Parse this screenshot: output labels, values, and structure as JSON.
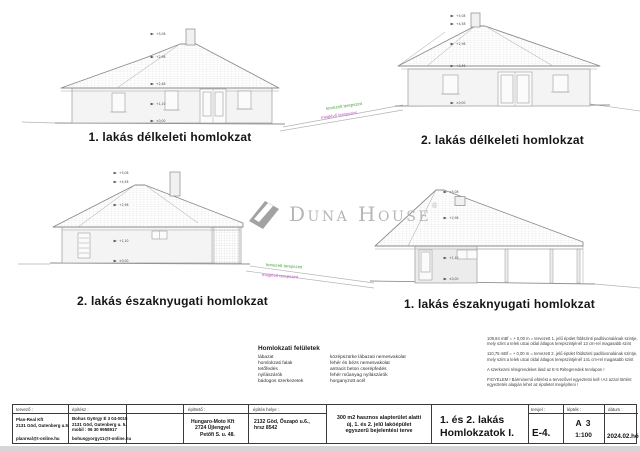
{
  "watermark": {
    "text": "Duna House",
    "reg": "®",
    "color": "#b6b6b6"
  },
  "elevation_labels": {
    "e1": "1. lakás délkeleti homlokzat",
    "e2": "2. lakás délkeleti homlokzat",
    "e3": "2. lakás északnyugati homlokzat",
    "e4": "1. lakás északnyugati homlokzat"
  },
  "terrain": {
    "planned": "tervezett terepszint",
    "existing": "meglévő terepszint",
    "planned_color": "#44a23a",
    "existing_color": "#bf4fbf"
  },
  "elevation_marks": [
    "+5,08",
    "+4,58",
    "+2,98",
    "+2,48",
    "+1,10",
    "±0,00"
  ],
  "legend": {
    "title": "Homlokzati felületek",
    "rows": [
      {
        "label": "lábazat",
        "value": "középszürke lábazati nemesvakolat"
      },
      {
        "label": "homlokzati falak",
        "value": "fehér és bézs nemesvakolat"
      },
      {
        "label": "tetőfedés",
        "value": "antracit beton cserépfedés"
      },
      {
        "label": "nyílászárók",
        "value": "fehér műanyag nyílászárók"
      },
      {
        "label": "bádogos szerkezetek",
        "value": "horganyzott acél"
      }
    ]
  },
  "notes": [
    "109,84 mBf = + 0,00 m = tervezett 1. jelű épület földszinti padlóvonalának szintje, mely szint a telek utcai oldal átlagos terepszintjénél 13 cm-rel magasabb szint",
    "110,75 mBf = + 0,00 m = tervezett 2. jelű épület földszinti padlóvonalának szintje, mely szint a telek utcai oldal átlagos terepszintjénél 141 cm-rel magasabb szint",
    "A szerkezeti rétegrendeket lásd az E-5 Rétegrendek tervlapon !",
    "FIGYELEM ! Bárminemű eltérést a tervezővel egyeztetni kell ! Az azzal történt egyeztetés alapján lehet az épületet megépíteni !"
  ],
  "titleblock": {
    "tervezo": {
      "header": "tervező :",
      "line1": "Plan-Real Kft",
      "line2": "2131 Göd, Gutenberg u.5.",
      "email": "planreal@t-online.hu"
    },
    "epitesz": {
      "header": "építész :",
      "line1": "Bohus György É 3 04-0018",
      "line2": "2131 Göd, Gutenberg u. 5.",
      "line3": "mobil : 06 30 9958917",
      "email": "bohusgyorgy11@t-online.hu"
    },
    "epitteto": {
      "header": "építtető :",
      "line1": "Hungaro-Moto Kft",
      "line2": "2724 Újlengyel",
      "line3": "Petőfi S. u. 48."
    },
    "helyszin": {
      "header": "építés helye :",
      "line1": "2132 Göd, Őszapó u.6.,",
      "line2": "hrsz 8542"
    },
    "megnevezes": {
      "line1": "300 m2 hasznos alapterület alatti",
      "line2": "új, 1. és 2. jelű lakóépület",
      "line3": "egyszerű bejelentési terve"
    },
    "rajz_cim": {
      "line1": "1. és 2. lakás",
      "line2": "Homlokzatok I."
    },
    "tervjel": {
      "header": "tervjel :",
      "value": "E-4."
    },
    "leptek": {
      "header": "lépték :",
      "size": "A 3",
      "scale": "1:100"
    },
    "datum": {
      "header": "dátum :",
      "value": "2024.02.hó"
    }
  }
}
